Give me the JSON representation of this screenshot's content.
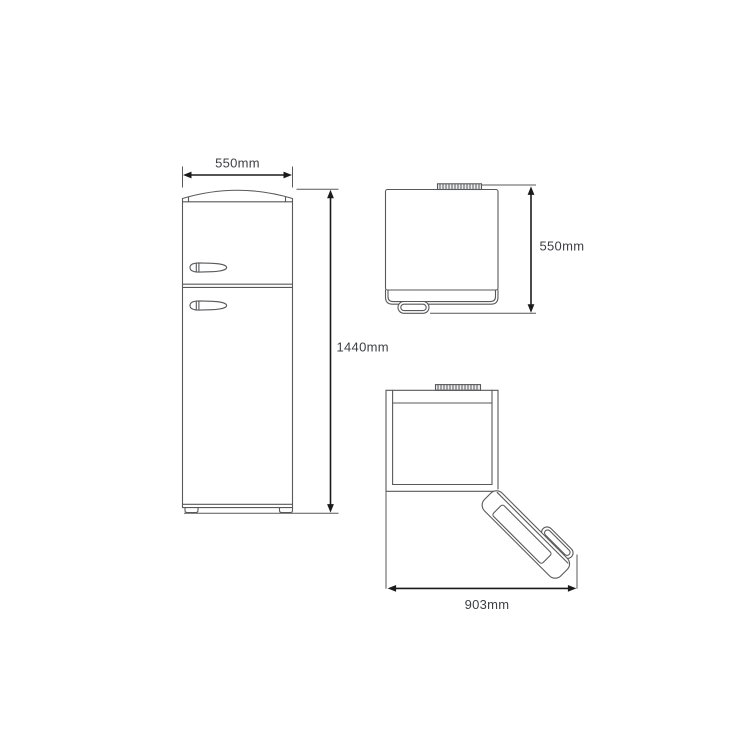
{
  "colors": {
    "background": "#ffffff",
    "product_outline": "#58595b",
    "dimension_line": "#1b1b1d",
    "label_text": "#3e3f45",
    "hinge_fill": "#ececec"
  },
  "labels": {
    "front_width": "550mm",
    "front_height": "1440mm",
    "side_depth": "550mm",
    "open_depth": "903mm"
  }
}
